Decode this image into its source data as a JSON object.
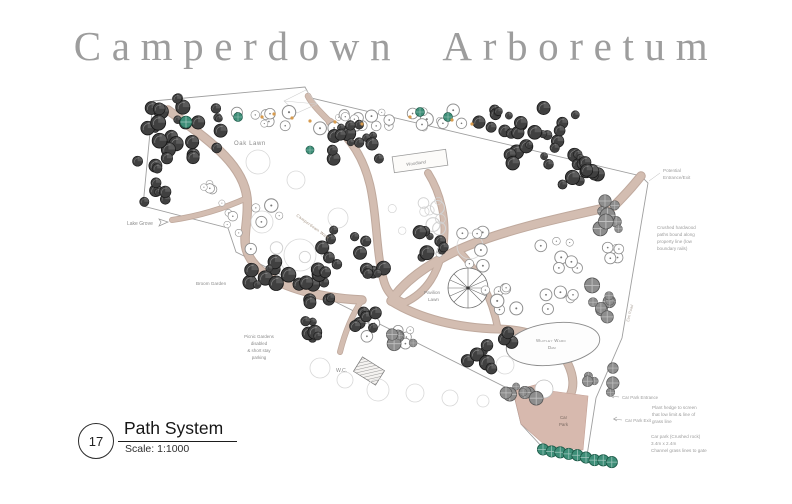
{
  "title": "Camperdown Arboretum",
  "legend": {
    "number": "17",
    "name": "Path System",
    "scale": "Scale: 1:1000"
  },
  "map": {
    "labels": {
      "oak_lawn": "Oak Lawn",
      "woodland": "Woodland",
      "pavilion_lawn_1": "Pavilion",
      "pavilion_lawn_2": "Lawn",
      "dam_1": "Whitley Ward",
      "dam_2": "Dam",
      "lake_grove": "Lake Grove",
      "broom_garden": "Broom Garden",
      "picnic_1": "Picnic Gardens",
      "picnic_2": "disabled",
      "picnic_3": "& short stay",
      "picnic_4": "parking",
      "wc": "W.C.",
      "car_park_1": "Car",
      "car_park_2": "Park",
      "path_name": "Camperdown Walk",
      "elm_road": "Elm Road"
    }
  },
  "annotations": {
    "potential": {
      "lines": [
        "Potential",
        "Entrance/Exit"
      ]
    },
    "hardwood": {
      "lines": [
        "Crushed hardwood",
        "paths bound along",
        "property line (low",
        "boundary rails)"
      ]
    },
    "hedge": {
      "lines": [
        "Plant hedge to screen",
        "that low limit & line of",
        "grass line"
      ]
    },
    "car_park_entrance": "Car Park Entrance",
    "car_park_exit": "Car Park Exit",
    "car_park_note": {
      "lines": [
        "Car park (Crushed rock)",
        "3.4m x 2.4m",
        "Channel grass lines to gate"
      ]
    }
  },
  "colors": {
    "title_gray": "#9d9d9d",
    "path_tan": "#d3bdb1",
    "path_edge": "#b9a093",
    "car_park_pink": "#d7b9ae",
    "tree_dark": "#404040",
    "tree_teal": "#3e8e78",
    "accent_orange": "#d79b4e",
    "boundary_gray": "#9f9f9f"
  }
}
